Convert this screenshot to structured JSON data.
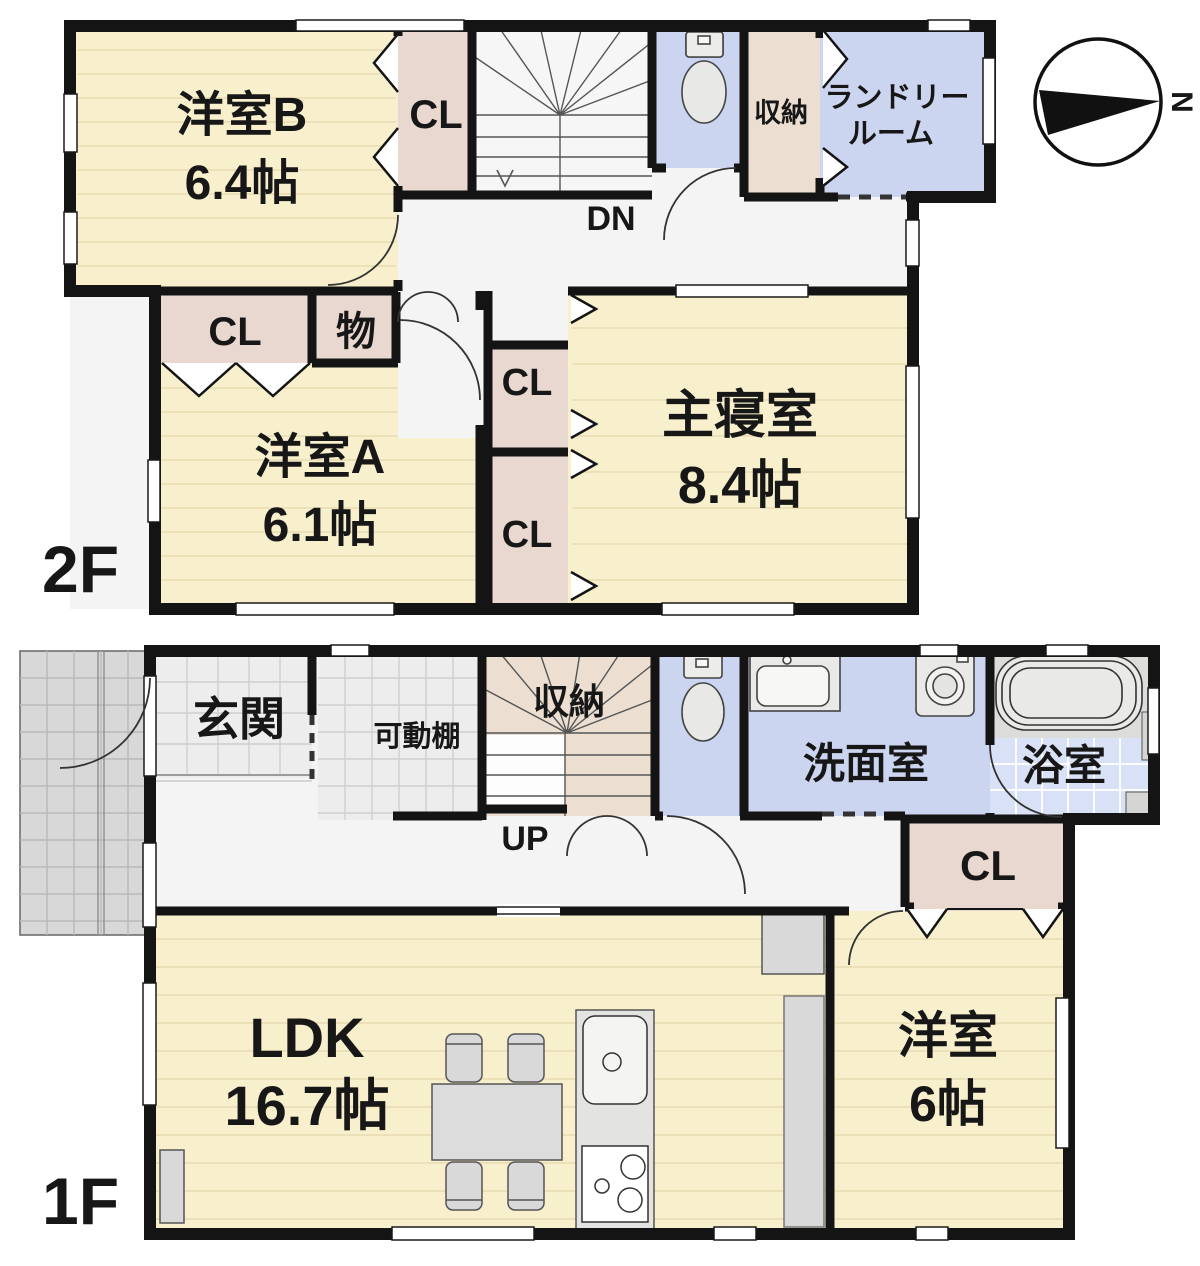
{
  "title": "間取り図",
  "floors": {
    "f2": {
      "label": "2F",
      "rooms": {
        "yoshitsu_b": {
          "name": "洋室B",
          "size": "6.4帖"
        },
        "closet_b": "CL",
        "stairs": "DN",
        "storage": "収納",
        "laundry": {
          "line1": "ランドリー",
          "line2": "ルーム"
        },
        "closet_a": "CL",
        "mono": "物",
        "yoshitsu_a": {
          "name": "洋室A",
          "size": "6.1帖"
        },
        "closet_mid_upper": "CL",
        "closet_mid_lower": "CL",
        "master": {
          "name": "主寝室",
          "size": "8.4帖"
        }
      }
    },
    "f1": {
      "label": "1F",
      "rooms": {
        "entrance": "玄関",
        "movable_shelf": "可動棚",
        "storage": "収納",
        "stairs": "UP",
        "washroom": "洗面室",
        "bathroom": "浴室",
        "closet": "CL",
        "ldk": {
          "name": "LDK",
          "size": "16.7帖"
        },
        "yoshitsu": {
          "name": "洋室",
          "size": "6帖"
        }
      }
    }
  },
  "compass": {
    "north": "N"
  },
  "colors": {
    "wall": "#141414",
    "room_cream": "#f8efcd",
    "floor_line": "#e3d7ab",
    "closet_pink": "#e9d8cf",
    "storage_beige": "#ecdfd2",
    "water_blue": "#ccd5f0",
    "bath_tile": "#d9e1f7",
    "tile_gray": "#ededed",
    "porch_gray": "#d8d8d8",
    "hall_white": "#f4f4f5",
    "fixture_gray": "#dcdcda"
  }
}
